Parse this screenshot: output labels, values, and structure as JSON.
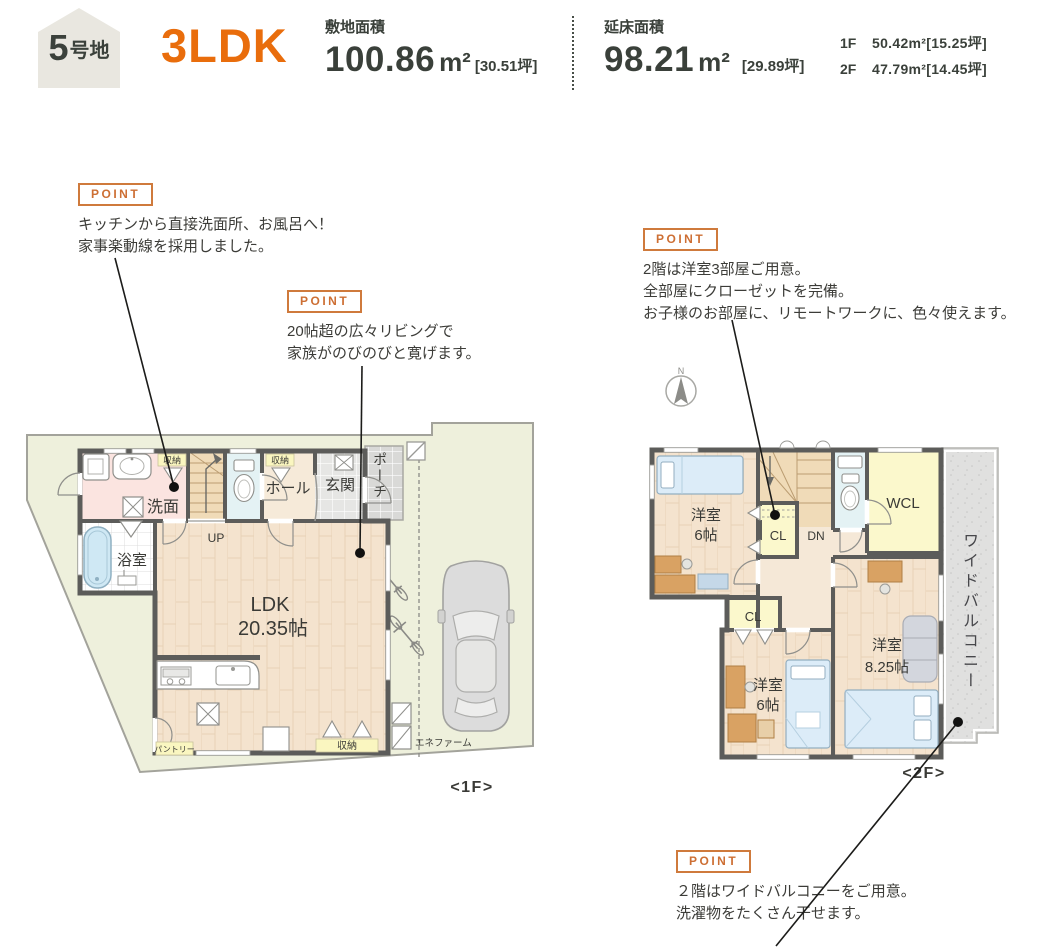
{
  "header": {
    "lot_badge": {
      "number": "5",
      "suffix": "号地"
    },
    "plan_type": "3LDK",
    "site_area": {
      "label": "敷地面積",
      "value": "100.86",
      "unit": "m²",
      "tsubo": "[30.51坪]"
    },
    "floor_area": {
      "label": "延床面積",
      "value": "98.21",
      "unit": "m²",
      "tsubo": "[29.89坪]"
    },
    "floor_breakdown": [
      {
        "floor": "1F",
        "area": "50.42m²[15.25坪]"
      },
      {
        "floor": "2F",
        "area": "47.79m²[14.45坪]"
      }
    ]
  },
  "points": [
    {
      "label": "POINT",
      "lines": [
        "キッチンから直接洗面所、お風呂へ！",
        "家事楽動線を採用しました。"
      ]
    },
    {
      "label": "POINT",
      "lines": [
        "20帖超の広々リビングで",
        "家族がのびのびと寛げます。"
      ]
    },
    {
      "label": "POINT",
      "lines": [
        "2階は洋室3部屋ご用意。",
        "全部屋にクローゼットを完備。",
        "お子様のお部屋に、リモートワークに、色々使えます。"
      ]
    },
    {
      "label": "POINT",
      "lines": [
        "２階はワイドバルコニーをご用意。",
        "洗濯物をたくさん干せます。"
      ]
    }
  ],
  "floor1": {
    "caption": "<1F>",
    "labels": {
      "washroom": "洗面",
      "bath": "浴室",
      "hall": "ホール",
      "entrance": "玄関",
      "porch": "ポーチ",
      "up": "UP",
      "ldk1": "LDK",
      "ldk2": "20.35帖",
      "pantry": "パントリー",
      "storage_top1": "収納",
      "storage_top2": "収納",
      "storage_bottom": "収納",
      "enefarm": "エネファーム"
    }
  },
  "floor2": {
    "caption": "<2F>",
    "compass_n": "N",
    "labels": {
      "room1a": "洋室",
      "room1b": "6帖",
      "cl1": "CL",
      "dn": "DN",
      "wcl": "WCL",
      "cl2": "CL",
      "room2a": "洋室",
      "room2b": "6帖",
      "room3a": "洋室",
      "room3b": "8.25帖",
      "balcony": "ワイドバルコニー"
    }
  }
}
